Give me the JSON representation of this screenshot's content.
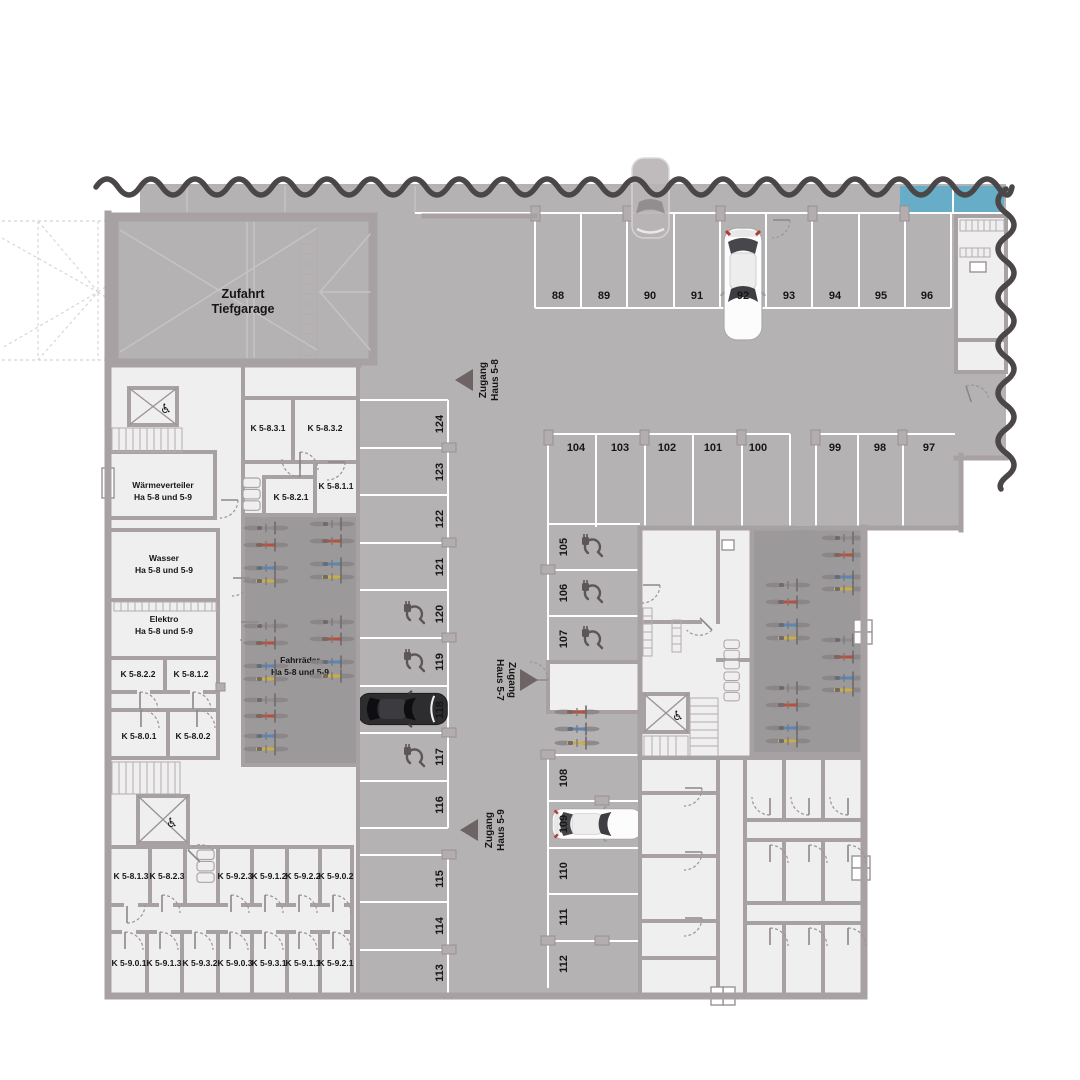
{
  "plan_type": "Tiefgarage Grundriss",
  "colors": {
    "floor": "#b5b2b4",
    "bike_room_floor": "#9c999b",
    "wall": "#a8a1a3",
    "room": "#f0efef",
    "stall_line": "#ffffff",
    "cut_line": "#4b4648",
    "highlight_blue": "#68adc8",
    "text": "#161616",
    "arrow": "#6e6466"
  },
  "ramp": {
    "line1": "Zufahrt",
    "line2": "Tiefgarage"
  },
  "access": [
    {
      "line1": "Zugang",
      "line2": "Haus 5-8"
    },
    {
      "line1": "Zugang",
      "line2": "Haus 5-7"
    },
    {
      "line1": "Zugang",
      "line2": "Haus 5-9"
    }
  ],
  "parking": {
    "row_top": [
      "88",
      "89",
      "90",
      "91",
      "92",
      "93",
      "94",
      "95",
      "96"
    ],
    "row_second": [
      "104",
      "103",
      "102",
      "101",
      "100",
      "99",
      "98",
      "97"
    ],
    "col_west": [
      "124",
      "123",
      "122",
      "121",
      "120",
      "119",
      "118",
      "117",
      "116",
      "115",
      "114",
      "113"
    ],
    "col_center": [
      "105",
      "106",
      "107",
      "108",
      "109",
      "110",
      "111",
      "112"
    ],
    "ev_charging_spots": [
      "105",
      "106",
      "107",
      "117",
      "119",
      "120"
    ],
    "occupied_spots": [
      "92",
      "109",
      "118"
    ]
  },
  "rooms": {
    "k_upper": [
      "K 5-8.3.1",
      "K 5-8.3.2",
      "K 5-8.1.1",
      "K 5-8.2.1"
    ],
    "tech": [
      [
        "Wärmeverteiler",
        "Ha 5-8 und 5-9"
      ],
      [
        "Wasser",
        "Ha 5-8 und 5-9"
      ],
      [
        "Elektro",
        "Ha 5-8 und 5-9"
      ],
      [
        "Fahrräder",
        "Ha 5-8 und 5-9"
      ]
    ],
    "k_mid": [
      "K 5-8.2.2",
      "K 5-8.1.2",
      "K 5-8.0.1",
      "K 5-8.0.2"
    ],
    "k_south_row1": [
      "K 5-8.1.3",
      "K 5-8.2.3",
      "K 5-9.2.3",
      "K 5-9.1.2",
      "K 5-9.2.2",
      "K 5-9.0.2"
    ],
    "k_south_row2": [
      "K 5-9.0.1",
      "K 5-9.1.3",
      "K 5-9.3.2",
      "K 5-9.0.3",
      "K 5-9.3.1",
      "K 5-9.1.1",
      "K 5-9.2.1"
    ]
  },
  "icons": {
    "elevator": "elevator-icon",
    "wheelchair": "wheelchair-icon",
    "wheelchair_glyph": "♿",
    "ev": "ev-charging-icon",
    "bike": "bicycle-icon",
    "car": "car-icon",
    "stairs": "stairs-icon",
    "trolley": "trolley-icon"
  }
}
